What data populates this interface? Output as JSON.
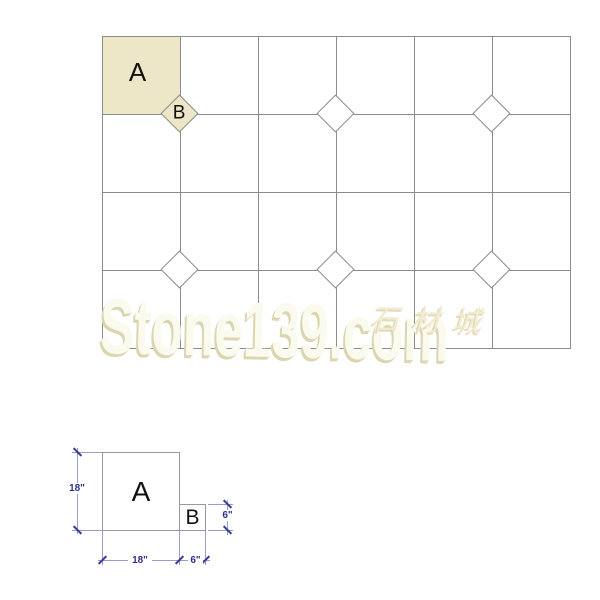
{
  "pattern": {
    "cols": 6,
    "rows": 4,
    "tile_a_label": "A",
    "highlight_color": "#EDE6C7",
    "line_color": "#8C8C8C",
    "diamonds": [
      {
        "col": 1,
        "row": 1,
        "filled": true,
        "label": "B"
      },
      {
        "col": 3,
        "row": 1,
        "filled": false,
        "label": ""
      },
      {
        "col": 5,
        "row": 1,
        "filled": false,
        "label": ""
      },
      {
        "col": 1,
        "row": 3,
        "filled": false,
        "label": ""
      },
      {
        "col": 3,
        "row": 3,
        "filled": false,
        "label": ""
      },
      {
        "col": 5,
        "row": 3,
        "filled": false,
        "label": ""
      }
    ]
  },
  "watermark": {
    "text": "Stone139.com",
    "cjk": "石材城"
  },
  "detail": {
    "tile_a_label": "A",
    "tile_b_label": "B",
    "dims": {
      "a_height": "18\"",
      "a_width": "18\"",
      "b_width": "6\"",
      "b_height": "6\""
    }
  }
}
